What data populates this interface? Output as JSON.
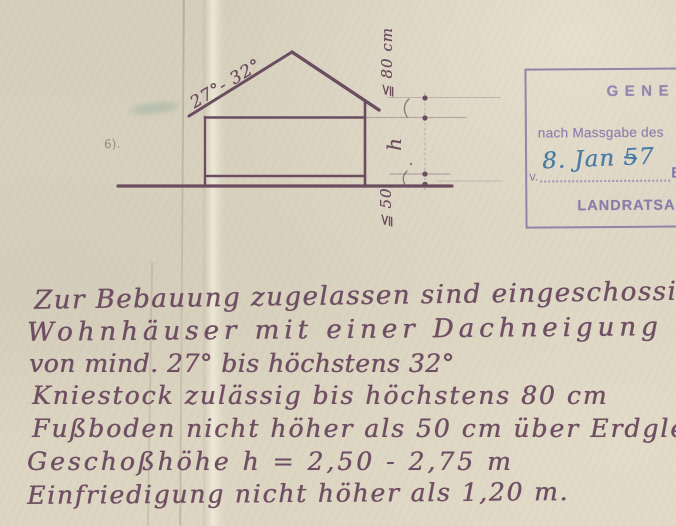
{
  "diagram": {
    "roof_angle_label": "27°- 32°",
    "knee_wall_label": "≦ 80 cm",
    "storey_height_label": "h",
    "floor_height_label": "≦ 50",
    "pencil_note": "6)."
  },
  "stamp": {
    "title_visible": "GENE",
    "subtitle_visible": "nach Massgabe des",
    "date_prefix": "v.",
    "date_value": "8. Jan 57",
    "after_date_visible": "B",
    "footer_visible": "LANDRATSAM",
    "stamp_ink_color": "#8b7cab",
    "date_ink_color": "#4a7ba6"
  },
  "handwriting": {
    "ink_color": "#6f4e63",
    "lines": [
      "Zur Bebauung zugelassen sind eingeschossige",
      "Wohnhäuser mit einer Dachneigung",
      "von mind. 27° bis höchstens 32°",
      "Kniestock zulässig bis höchstens 80 cm",
      "Fußboden nicht höher als 50 cm über Erdgleiche",
      "Geschoßhöhe h = 2,50 - 2,75 m",
      "Einfriedigung nicht höher als 1,20 m."
    ]
  },
  "colors": {
    "paper": "#d8d1be",
    "drawing_ink": "#6b4d60"
  }
}
